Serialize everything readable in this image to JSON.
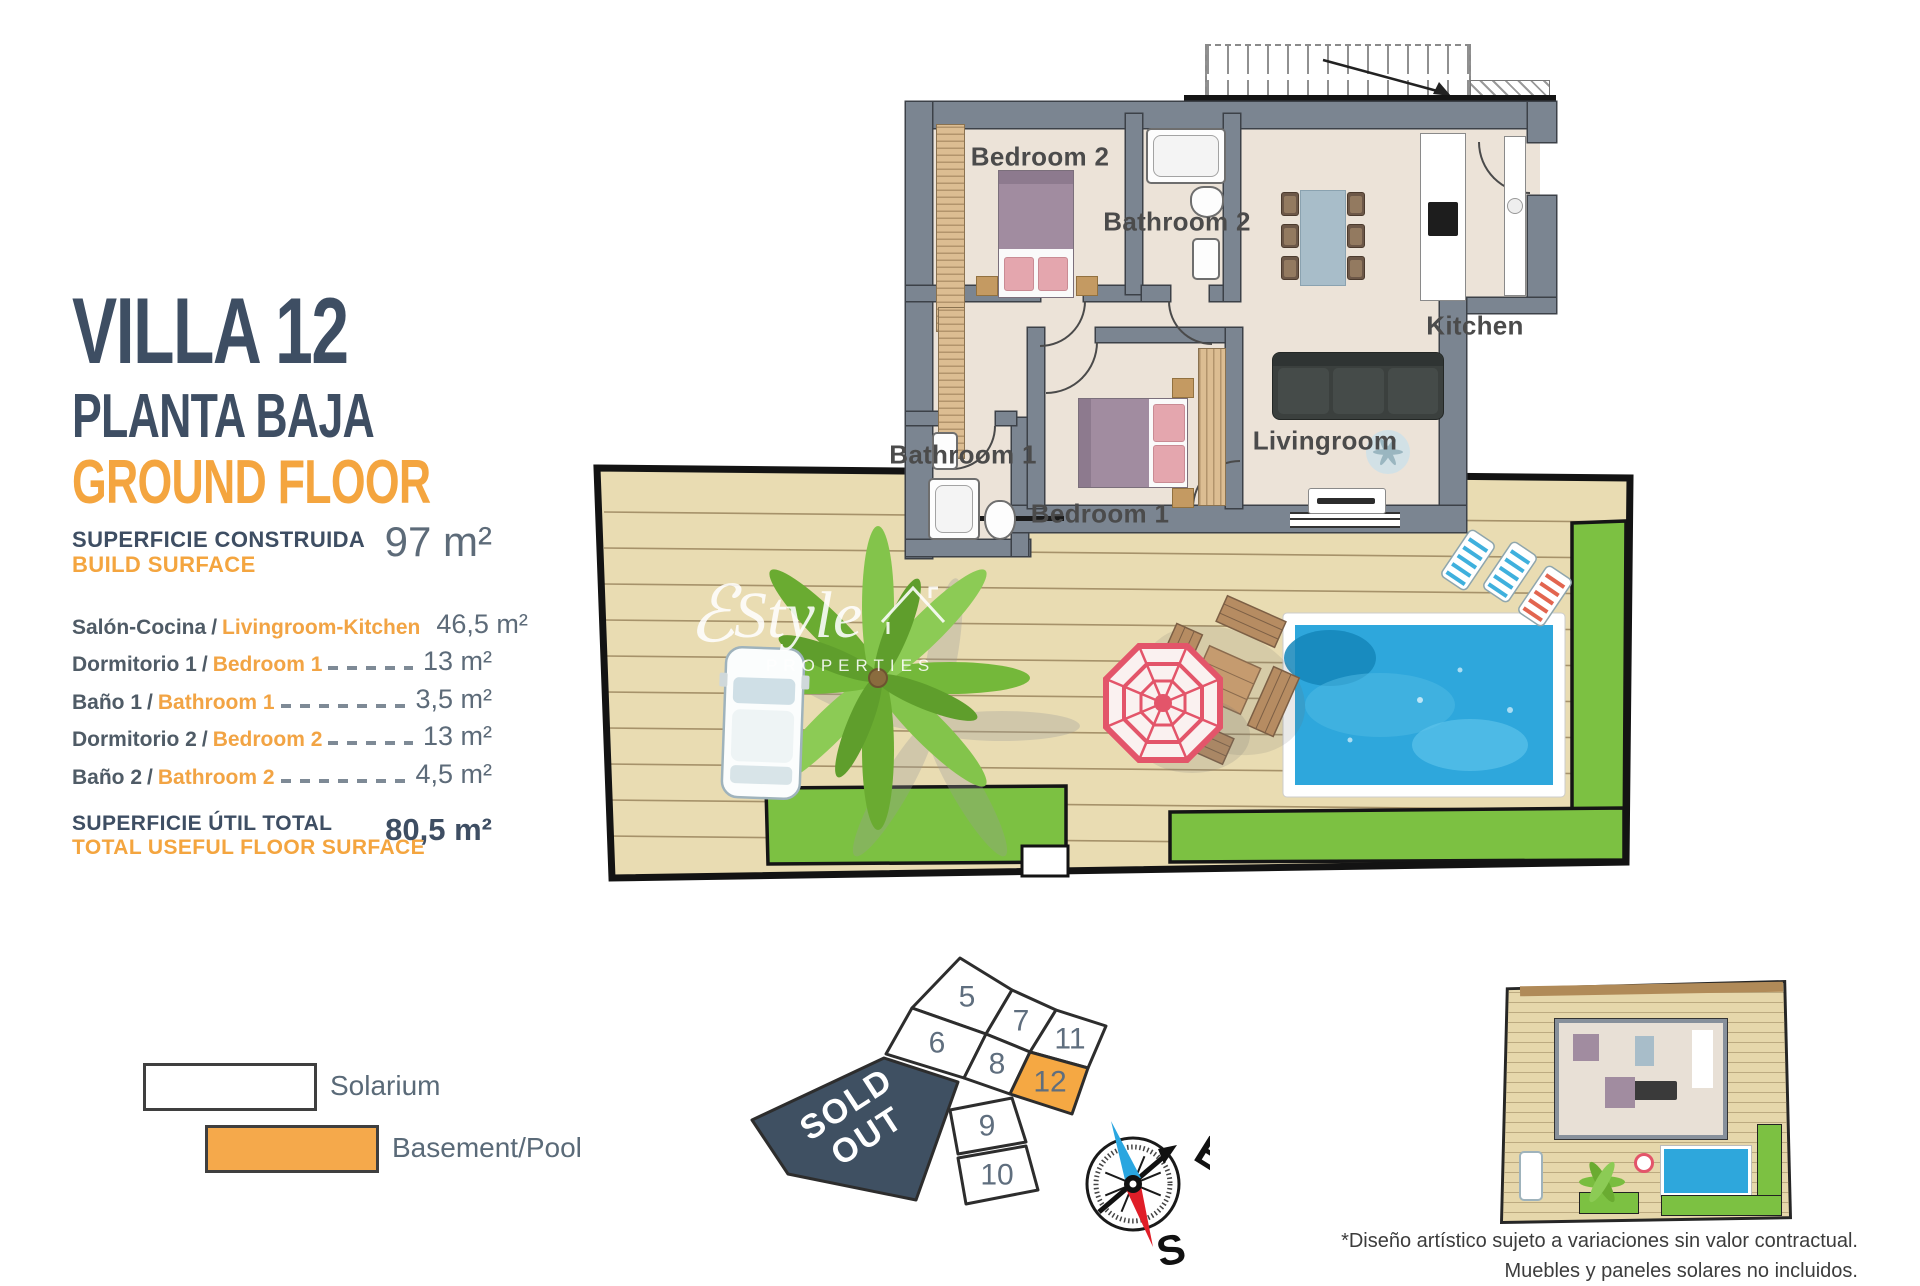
{
  "info": {
    "title": "VILLA 12",
    "subtitle_es": "PLANTA BAJA",
    "subtitle_en": "GROUND FLOOR",
    "separator": "/",
    "build": {
      "label_es": "SUPERFICIE CONSTRUIDA",
      "label_en": "BUILD SURFACE",
      "value": "97 m²"
    },
    "rooms": [
      {
        "es": "Salón-Cocina",
        "en": "Livingroom-Kitchen",
        "value": "46,5 m²"
      },
      {
        "es": "Dormitorio 1",
        "en": "Bedroom 1",
        "value": "13 m²"
      },
      {
        "es": "Baño 1",
        "en": "Bathroom 1",
        "value": "3,5 m²"
      },
      {
        "es": "Dormitorio 2",
        "en": "Bedroom 2",
        "value": "13 m²"
      },
      {
        "es": "Baño 2",
        "en": "Bathroom 2",
        "value": "4,5 m²"
      }
    ],
    "total": {
      "label_es": "SUPERFICIE ÚTIL TOTAL",
      "label_en": "TOTAL USEFUL FLOOR SURFACE",
      "value": "80,5 m²"
    }
  },
  "legend": {
    "items": [
      {
        "label": "Solarium",
        "swatch": "#ffffff"
      },
      {
        "label": "Basement/Pool",
        "swatch": "#f5a94b"
      }
    ]
  },
  "floorplan": {
    "labels": {
      "bedroom2": "Bedroom 2",
      "bathroom2": "Bathroom 2",
      "kitchen": "Kitchen",
      "livingroom": "Livingroom",
      "bathroom1": "Bathroom 1",
      "bedroom1": "Bedroom 1"
    }
  },
  "plot_map": {
    "plots": [
      "5",
      "6",
      "7",
      "8",
      "9",
      "10",
      "11",
      "12"
    ],
    "highlighted_plot": "12",
    "sold_out_line1": "SOLD",
    "sold_out_line2": "OUT",
    "compass": {
      "east": "E",
      "south": "S"
    }
  },
  "watermark": {
    "mark": "ℰ",
    "name": "Style",
    "sub": "PROPERTIES"
  },
  "disclaimer": {
    "line1": "*Diseño artístico sujeto a variaciones sin valor contractual.",
    "line2": "Muebles y paneles solares no incluidos."
  },
  "colors": {
    "slate": "#3e4e63",
    "orange": "#f2a444",
    "green": "#7cc142",
    "pool_blue": "#2ea7dc",
    "deck_tan": "#e9dcb2",
    "wall_gray": "#7b8591",
    "sold_out_bg": "#3f5062",
    "highlight_orange": "#f5a843"
  }
}
